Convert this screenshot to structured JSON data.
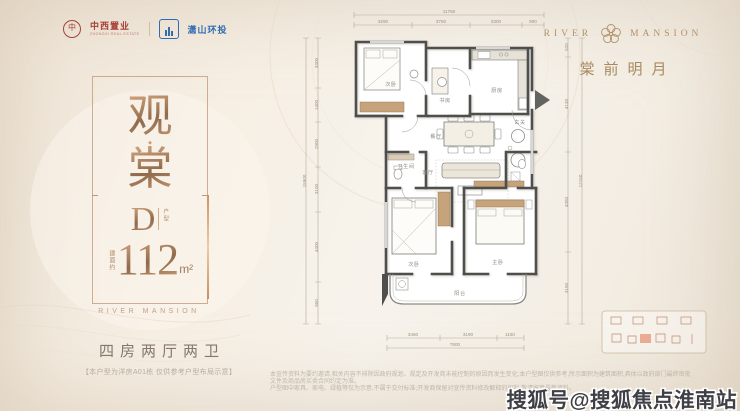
{
  "logos": {
    "developer": {
      "seal_char": "中",
      "name": "中西置业",
      "sub": "ZHONGXI REAL ESTATE"
    },
    "partner": {
      "name": "潇山环投"
    }
  },
  "brand": {
    "river": "RIVER",
    "mansion": "MANSION",
    "slogan": "棠前明月"
  },
  "panel": {
    "title_top": "观",
    "title_dot": "◆",
    "title_bottom": "棠",
    "unit_letter": "D",
    "unit_suffix": "户型",
    "area_prefix": "建面约",
    "area_number": "112",
    "area_unit": "m²",
    "caption": "RIVER MANSION",
    "layout": "四房两厅两卫",
    "note": "【本户型为洋房A01栋 仅供参考户型布局示意】"
  },
  "floorplan": {
    "rooms": {
      "bed2": "次卧",
      "study": "书房",
      "kitchen": "厨房",
      "foyer": "玄关",
      "dining": "餐厅",
      "living": "客厅",
      "bath": "卫生间",
      "bed3": "次卧",
      "master": "主卧",
      "balcony": "阳台"
    },
    "dims": {
      "top": {
        "total": "11750",
        "segments": [
          "3290",
          "3750",
          "3300",
          "900"
        ]
      },
      "left": {
        "total": "15900",
        "segments": [
          "3300",
          "1400",
          "2900",
          "3100",
          "4400",
          "950"
        ]
      },
      "right": {
        "total": "12150",
        "segments": [
          "520",
          "4130",
          "4350",
          "3150"
        ]
      },
      "bottom": {
        "total": "7800",
        "segments": [
          "3460",
          "3190",
          "1150"
        ]
      }
    }
  },
  "fine_print": {
    "line1": "本宣传资料为要约邀请,相关内容不排除因政府规划、规定及开发商未能控制的原因而发生变化;本户型图仅供参考,所示面积为建筑面积,具体以政府部门最终审批文件及商品房买卖合同约定为准。",
    "line2": "户型图中家具、家电、绿植等仅为示意,不属于交付标准;开发商保留对宣传资料修改解释的权利,敬请留意最新资料。"
  },
  "watermark": "搜狐号@搜狐焦点淮南站"
}
